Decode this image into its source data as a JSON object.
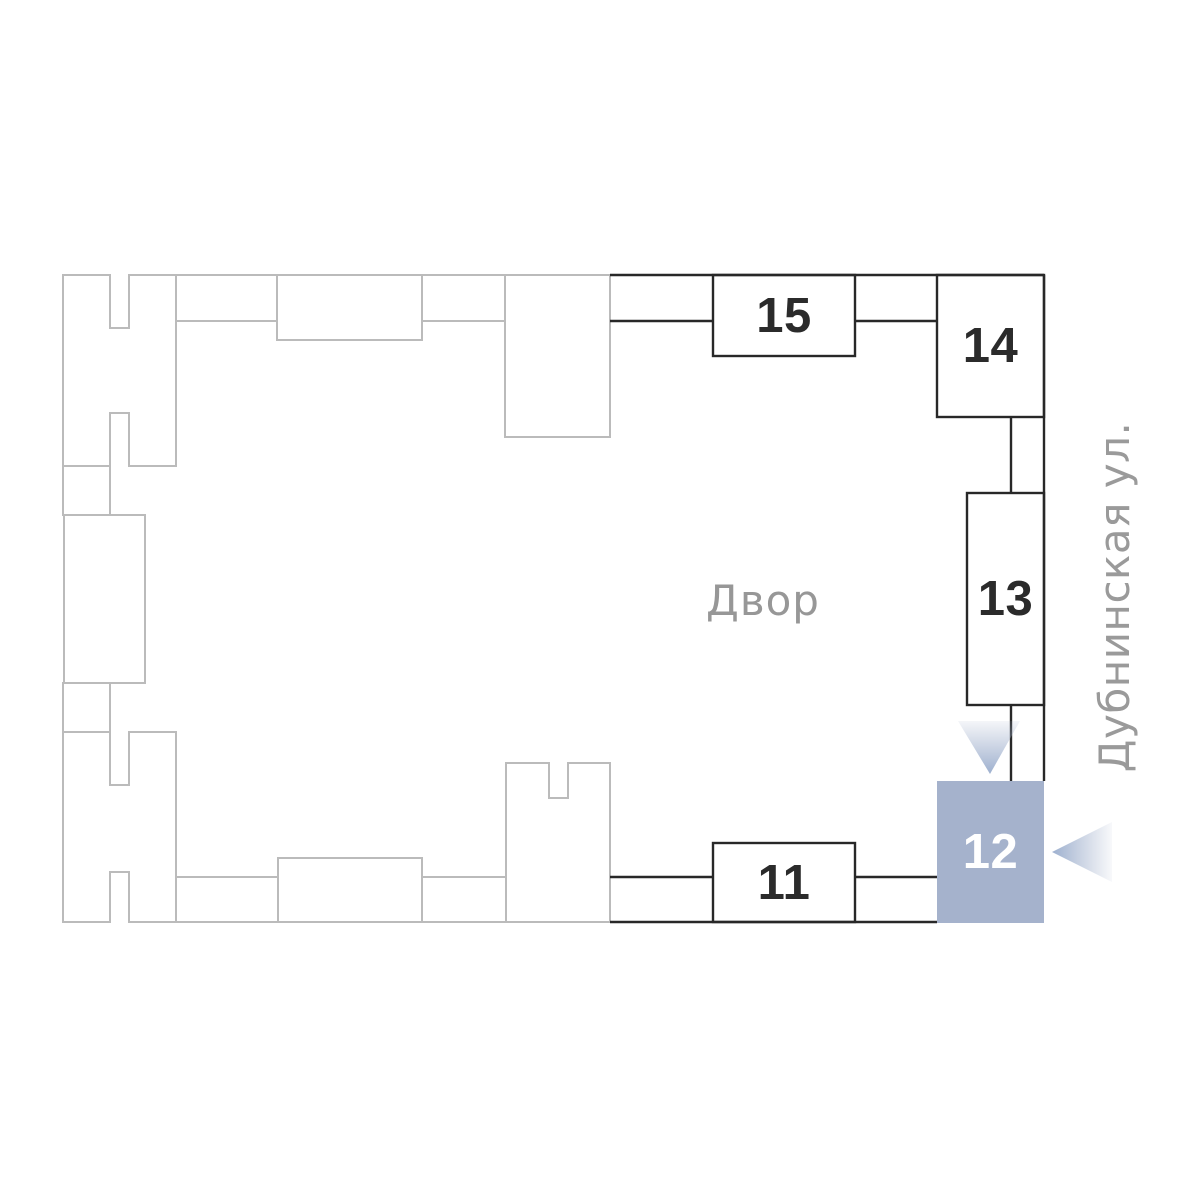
{
  "plan": {
    "courtyard_label": "Двор",
    "street_label": "Дубнинская ул.",
    "buildings": [
      {
        "id": "15",
        "label": "15",
        "state": "default"
      },
      {
        "id": "14",
        "label": "14",
        "state": "default"
      },
      {
        "id": "13",
        "label": "13",
        "state": "default"
      },
      {
        "id": "12",
        "label": "12",
        "state": "selected"
      },
      {
        "id": "11",
        "label": "11",
        "state": "default"
      }
    ],
    "selected_building": "12",
    "colors": {
      "highlight": "#a5b2cc",
      "outline_dark": "#282828",
      "outline_light": "#bbbbbb",
      "text_gray": "#979797",
      "number_dark": "#2b2b2b",
      "number_selected": "#ffffff",
      "arrow_blue": "#9db0cf"
    }
  }
}
